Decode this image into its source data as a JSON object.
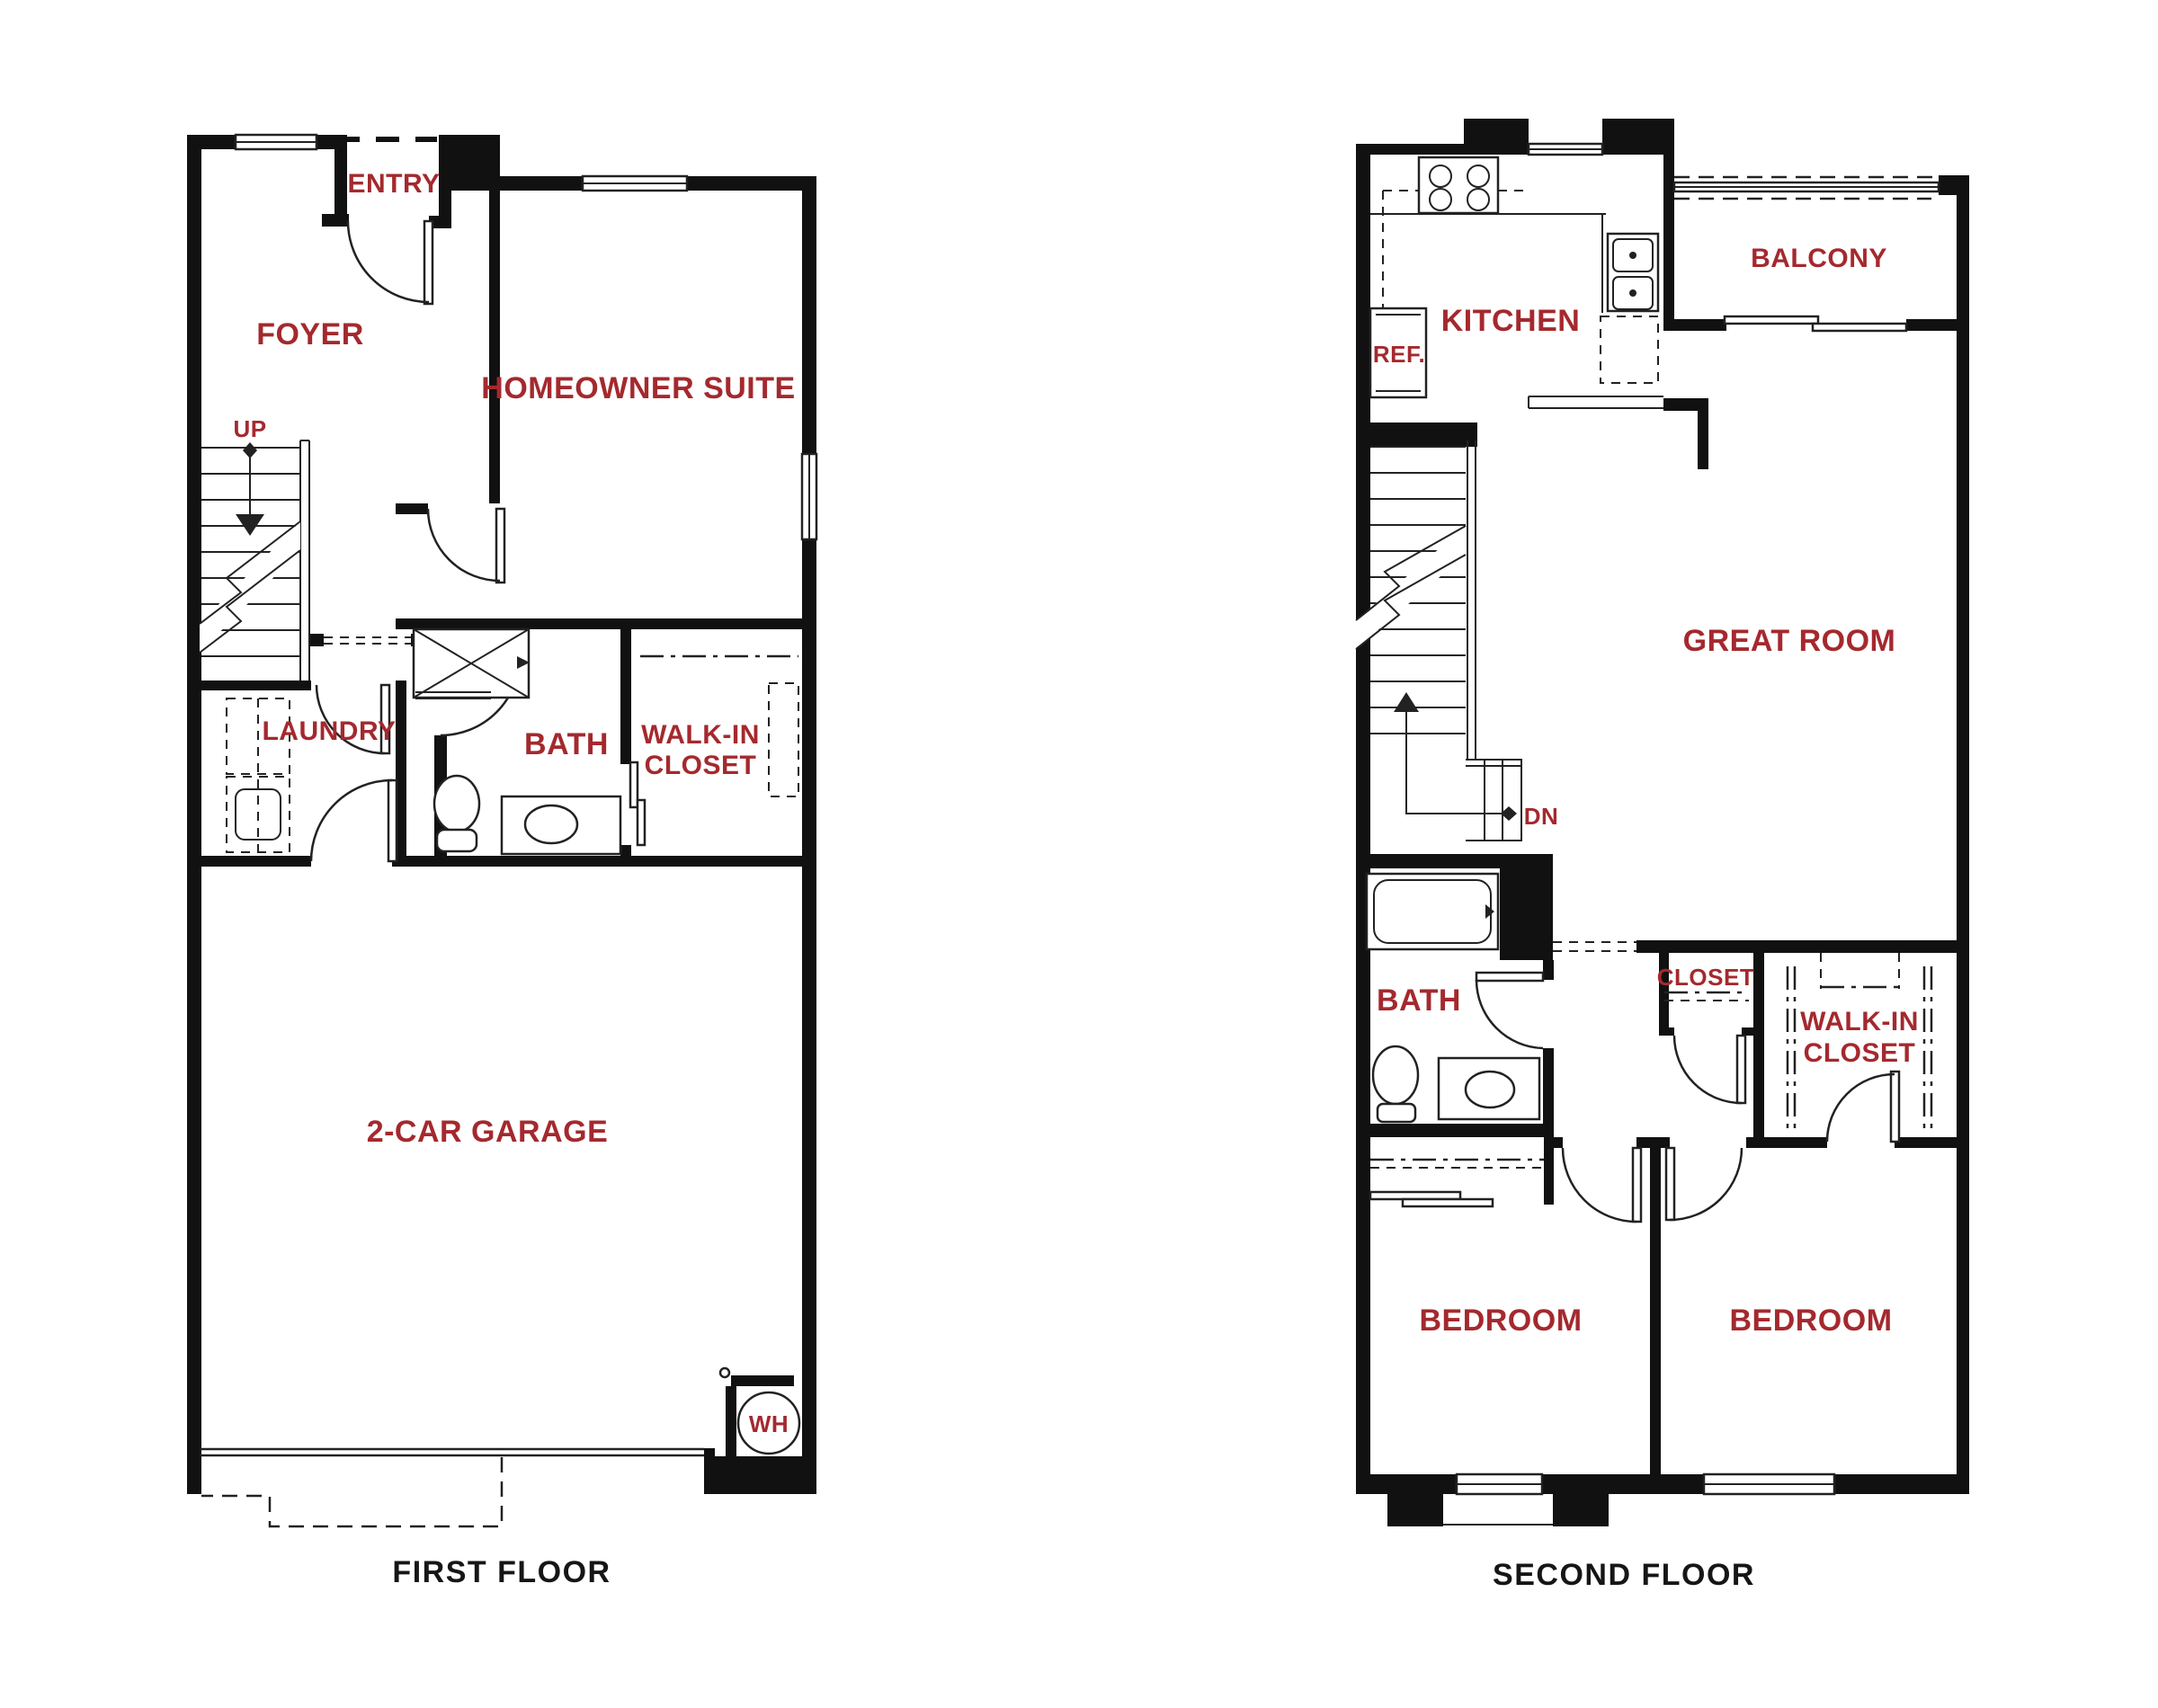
{
  "colors": {
    "label_red": "#A4292E",
    "wall_black": "#111111",
    "line_dark": "#222222",
    "paper": "#FFFFFF"
  },
  "first_floor": {
    "name": "FIRST FLOOR",
    "rooms": {
      "entry": "ENTRY",
      "foyer": "FOYER",
      "homeowner_suite": "HOMEOWNER SUITE",
      "laundry": "LAUNDRY",
      "bath": "BATH",
      "walk_in_closet_line1": "WALK-IN",
      "walk_in_closet_line2": "CLOSET",
      "garage": "2-CAR GARAGE"
    },
    "annotations": {
      "up": "UP",
      "water_heater": "WH"
    }
  },
  "second_floor": {
    "name": "SECOND FLOOR",
    "rooms": {
      "kitchen": "KITCHEN",
      "balcony": "BALCONY",
      "great_room": "GREAT ROOM",
      "bath": "BATH",
      "closet": "CLOSET",
      "walk_in_closet_line1": "WALK-IN",
      "walk_in_closet_line2": "CLOSET",
      "bedroom_left": "BEDROOM",
      "bedroom_right": "BEDROOM"
    },
    "annotations": {
      "dn": "DN",
      "refrigerator": "REF."
    }
  }
}
